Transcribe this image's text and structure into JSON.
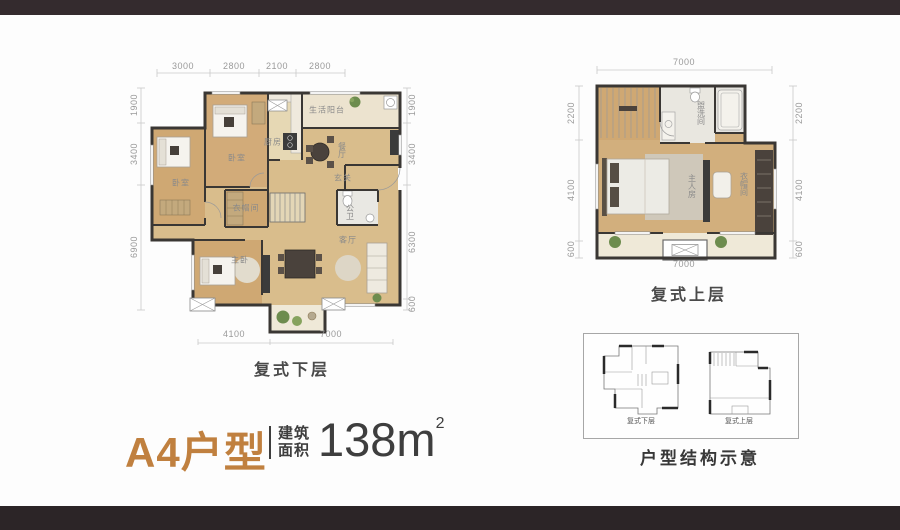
{
  "title_block": {
    "name": "A4户型",
    "area_label_top": "建筑",
    "area_label_bottom": "面积",
    "area_value": "138m",
    "area_superscript": "2"
  },
  "lower_plan": {
    "caption": "复式下层",
    "dims_top": [
      "3000",
      "2800",
      "2100",
      "2800"
    ],
    "dims_left": [
      "1900",
      "3400",
      "6900"
    ],
    "dims_right": [
      "1900",
      "3400",
      "6300",
      "600"
    ],
    "dims_bottom": [
      "4100",
      "7000"
    ],
    "rooms": {
      "bedroom_left": "卧室",
      "bedroom_top": "卧室",
      "kitchen": "厨房",
      "service_balcony": "生活阳台",
      "dining": "餐厅",
      "foyer": "玄关",
      "guest_bath": "公卫",
      "cloakroom": "衣帽间",
      "master_bedroom": "主卧",
      "living": "客厅"
    }
  },
  "upper_plan": {
    "caption": "复式上层",
    "dims_top": [
      "7000"
    ],
    "dims_left": [
      "2200",
      "4100",
      "600"
    ],
    "dims_right": [
      "2200",
      "4100",
      "600"
    ],
    "dims_bottom": [
      "7000"
    ],
    "rooms": {
      "washroom": "盥洗间",
      "master_room": "主人房",
      "wardrobe": "衣帽间"
    }
  },
  "structure_box": {
    "lower_label": "复式下层",
    "upper_label": "复式上层",
    "caption": "户型结构示意"
  },
  "colors": {
    "accent": "#c0803f",
    "frame_bar": "#342b2e",
    "wall": "#3a3734",
    "dim_text": "#9a9a9a"
  }
}
